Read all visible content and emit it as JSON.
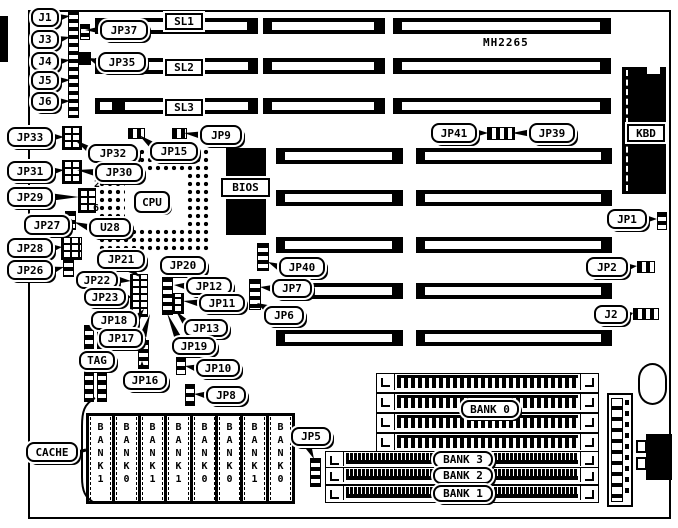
{
  "title": {
    "model": "MH2265"
  },
  "board": {
    "x": 28,
    "y": 10,
    "w": 643,
    "h": 509
  },
  "edge_bar": {
    "x": 0,
    "y": 16,
    "w": 8,
    "h": 46
  },
  "isa_slots": {
    "rows_three_seg": {
      "ys": [
        18,
        58,
        98
      ],
      "h": 16,
      "segments": [
        [
          95,
          258
        ],
        [
          263,
          385
        ],
        [
          393,
          611
        ]
      ]
    },
    "rows_two_seg": {
      "ys": [
        148,
        190,
        237,
        283,
        330
      ],
      "h": 16,
      "segments": [
        [
          276,
          403
        ],
        [
          416,
          612
        ]
      ]
    }
  },
  "cpu": {
    "socket": {
      "x": 98,
      "y": 148,
      "w": 112,
      "h": 104
    },
    "center": {
      "x": 125,
      "y": 173,
      "w": 60,
      "h": 55
    },
    "label": "CPU",
    "label_box": {
      "x": 134,
      "y": 191,
      "w": 36,
      "h": 22
    }
  },
  "bios": {
    "chip": {
      "x": 226,
      "y": 148,
      "w": 40,
      "h": 87
    },
    "label": "BIOS",
    "label_box": {
      "x": 221,
      "y": 178,
      "w": 49,
      "h": 19
    }
  },
  "kbd": {
    "chip": {
      "x": 622,
      "y": 67,
      "w": 44,
      "h": 127
    },
    "notch": {
      "x": 647,
      "y": 67,
      "w": 13,
      "h": 7
    },
    "label": "KBD",
    "label_box": {
      "x": 627,
      "y": 124,
      "w": 38,
      "h": 18
    }
  },
  "tag_chip": {
    "x": 84,
    "y": 325,
    "w": 23,
    "h": 77
  },
  "cache_chips": {
    "y": 413,
    "h": 80,
    "w": 23,
    "xs": [
      86,
      112,
      138,
      164,
      190,
      215,
      240,
      266
    ],
    "labels": [
      "BANK1",
      "BANK0",
      "BANK1",
      "BANK1",
      "BANK0",
      "BANK0",
      "BANK1",
      "BANK0"
    ]
  },
  "simm_bank0": {
    "x": 376,
    "x2": 597,
    "h": 18,
    "ys": [
      373,
      393,
      413,
      433
    ],
    "label": "BANK 0",
    "label_box": {
      "x": 461,
      "y": 400,
      "w": 58,
      "h": 18
    }
  },
  "simm_lower": {
    "x": 325,
    "x2": 597,
    "h": 16,
    "rows": [
      {
        "label": "BANK 3",
        "y": 451
      },
      {
        "label": "BANK 2",
        "y": 467
      },
      {
        "label": "BANK 1",
        "y": 485
      }
    ],
    "label_box": {
      "w": 60,
      "h": 17,
      "x": 433
    }
  },
  "power_connector": {
    "x": 607,
    "y": 393,
    "w": 26,
    "h": 114
  },
  "battery_blob": {
    "x": 638,
    "y": 363,
    "w": 29,
    "h": 42
  },
  "din_connector": {
    "x": 646,
    "y": 434,
    "w": 26,
    "h": 46,
    "tabs": [
      [
        636,
        440
      ],
      [
        636,
        457
      ]
    ]
  },
  "pin_labels": [
    {
      "id": "pin-2",
      "label": "2",
      "x": 94,
      "y": 179
    },
    {
      "id": "pin-6",
      "label": "6",
      "x": 93,
      "y": 203
    }
  ],
  "jumpers": [
    {
      "id": "edge-strip",
      "x": 68,
      "y": 10,
      "w": 9,
      "h": 106,
      "t": "v"
    },
    {
      "id": "jp37-j",
      "x": 80,
      "y": 24,
      "w": 8,
      "h": 14,
      "t": "v"
    },
    {
      "id": "jp35-j",
      "x": 78,
      "y": 52,
      "w": 11,
      "h": 11,
      "t": "s"
    },
    {
      "id": "jp15-j",
      "x": 128,
      "y": 128,
      "w": 15,
      "h": 9,
      "t": "h"
    },
    {
      "id": "jp9-j",
      "x": 172,
      "y": 128,
      "w": 13,
      "h": 9,
      "t": "h"
    },
    {
      "id": "jp33-b",
      "x": 62,
      "y": 126,
      "w": 18,
      "h": 22,
      "t": "b"
    },
    {
      "id": "jp31-b",
      "x": 62,
      "y": 160,
      "w": 18,
      "h": 22,
      "t": "b"
    },
    {
      "id": "jp29-b",
      "x": 78,
      "y": 188,
      "w": 16,
      "h": 23,
      "t": "b"
    },
    {
      "id": "jp27-j",
      "x": 65,
      "y": 211,
      "w": 9,
      "h": 17,
      "t": "v"
    },
    {
      "id": "jp28-b",
      "x": 61,
      "y": 237,
      "w": 19,
      "h": 21,
      "t": "b"
    },
    {
      "id": "jp26-j",
      "x": 63,
      "y": 258,
      "w": 9,
      "h": 17,
      "t": "v"
    },
    {
      "id": "strip-a",
      "x": 130,
      "y": 274,
      "w": 16,
      "h": 41,
      "t": "b"
    },
    {
      "id": "strip-b",
      "x": 162,
      "y": 277,
      "w": 9,
      "h": 36,
      "t": "v"
    },
    {
      "id": "strip-c",
      "x": 172,
      "y": 293,
      "w": 10,
      "h": 19,
      "t": "b"
    },
    {
      "id": "jp16-s",
      "x": 138,
      "y": 340,
      "w": 9,
      "h": 28,
      "t": "v"
    },
    {
      "id": "jp10-j",
      "x": 176,
      "y": 357,
      "w": 8,
      "h": 16,
      "t": "v"
    },
    {
      "id": "jp8-j",
      "x": 185,
      "y": 384,
      "w": 8,
      "h": 20,
      "t": "v"
    },
    {
      "id": "jp40-s",
      "x": 257,
      "y": 243,
      "w": 10,
      "h": 26,
      "t": "v"
    },
    {
      "id": "jp7-s",
      "x": 249,
      "y": 279,
      "w": 10,
      "h": 29,
      "t": "v"
    },
    {
      "id": "jp5-s",
      "x": 310,
      "y": 458,
      "w": 9,
      "h": 27,
      "t": "v"
    },
    {
      "id": "jp41-j",
      "x": 487,
      "y": 127,
      "w": 26,
      "h": 11,
      "t": "h"
    },
    {
      "id": "jp1-j",
      "x": 657,
      "y": 212,
      "w": 8,
      "h": 16,
      "t": "v"
    },
    {
      "id": "jp2-j",
      "x": 637,
      "y": 261,
      "w": 16,
      "h": 10,
      "t": "h"
    },
    {
      "id": "j2-j",
      "x": 633,
      "y": 308,
      "w": 24,
      "h": 10,
      "t": "h"
    }
  ],
  "callouts": [
    {
      "id": "j1",
      "label": "J1",
      "x": 31,
      "y": 8,
      "w": 28,
      "h": 19,
      "to": [
        70,
        16
      ]
    },
    {
      "id": "j3",
      "label": "J3",
      "x": 31,
      "y": 30,
      "w": 28,
      "h": 19,
      "to": [
        70,
        37
      ]
    },
    {
      "id": "j4",
      "label": "J4",
      "x": 31,
      "y": 52,
      "w": 28,
      "h": 19,
      "to": [
        70,
        60
      ]
    },
    {
      "id": "j5",
      "label": "J5",
      "x": 31,
      "y": 71,
      "w": 28,
      "h": 19,
      "to": [
        70,
        80
      ]
    },
    {
      "id": "j6",
      "label": "J6",
      "x": 31,
      "y": 92,
      "w": 28,
      "h": 19,
      "to": [
        70,
        101
      ]
    },
    {
      "id": "jp37",
      "label": "JP37",
      "x": 100,
      "y": 20,
      "w": 48,
      "h": 20,
      "to": [
        85,
        30
      ]
    },
    {
      "id": "jp35",
      "label": "JP35",
      "x": 98,
      "y": 52,
      "w": 48,
      "h": 20,
      "to": [
        88,
        58
      ]
    },
    {
      "id": "jp9",
      "label": "JP9",
      "x": 200,
      "y": 125,
      "w": 42,
      "h": 20,
      "to": [
        184,
        133
      ]
    },
    {
      "id": "jp15",
      "label": "JP15",
      "x": 150,
      "y": 142,
      "w": 48,
      "h": 19,
      "from": [
        152,
        145
      ],
      "to": [
        139,
        135
      ]
    },
    {
      "id": "jp33",
      "label": "JP33",
      "x": 7,
      "y": 127,
      "w": 46,
      "h": 20,
      "to": [
        64,
        137
      ]
    },
    {
      "id": "jp32",
      "label": "JP32",
      "x": 88,
      "y": 144,
      "w": 50,
      "h": 19,
      "from": [
        90,
        150
      ],
      "to": [
        75,
        140
      ]
    },
    {
      "id": "jp31",
      "label": "JP31",
      "x": 7,
      "y": 161,
      "w": 46,
      "h": 20,
      "to": [
        64,
        170
      ]
    },
    {
      "id": "jp30",
      "label": "JP30",
      "x": 95,
      "y": 163,
      "w": 48,
      "h": 19,
      "to": [
        77,
        170
      ]
    },
    {
      "id": "jp29",
      "label": "JP29",
      "x": 7,
      "y": 187,
      "w": 46,
      "h": 20,
      "to": [
        79,
        197
      ]
    },
    {
      "id": "jp27",
      "label": "JP27",
      "x": 24,
      "y": 215,
      "w": 46,
      "h": 20,
      "from": [
        70,
        222
      ],
      "to": [
        68,
        216
      ]
    },
    {
      "id": "u28",
      "label": "U28",
      "x": 89,
      "y": 218,
      "w": 42,
      "h": 19,
      "to": [
        74,
        222
      ]
    },
    {
      "id": "jp28",
      "label": "JP28",
      "x": 7,
      "y": 238,
      "w": 46,
      "h": 20,
      "to": [
        62,
        247
      ]
    },
    {
      "id": "jp26",
      "label": "JP26",
      "x": 7,
      "y": 260,
      "w": 46,
      "h": 20,
      "to": [
        64,
        267
      ]
    },
    {
      "id": "jp21",
      "label": "JP21",
      "x": 97,
      "y": 250,
      "w": 48,
      "h": 19,
      "from": [
        130,
        269
      ],
      "to": [
        140,
        277
      ]
    },
    {
      "id": "jp22",
      "label": "JP22",
      "x": 76,
      "y": 271,
      "w": 42,
      "h": 18,
      "to": [
        131,
        281
      ]
    },
    {
      "id": "jp23",
      "label": "JP23",
      "x": 84,
      "y": 288,
      "w": 42,
      "h": 18,
      "to": [
        131,
        297
      ]
    },
    {
      "id": "jp20",
      "label": "JP20",
      "x": 160,
      "y": 256,
      "w": 46,
      "h": 19,
      "from": [
        172,
        275
      ],
      "to": [
        166,
        282
      ]
    },
    {
      "id": "jp12",
      "label": "JP12",
      "x": 186,
      "y": 277,
      "w": 46,
      "h": 18,
      "to": [
        174,
        285
      ]
    },
    {
      "id": "jp11",
      "label": "JP11",
      "x": 199,
      "y": 294,
      "w": 46,
      "h": 18,
      "to": [
        183,
        301
      ]
    },
    {
      "id": "jp13",
      "label": "JP13",
      "x": 184,
      "y": 319,
      "w": 44,
      "h": 18,
      "from": [
        186,
        323
      ],
      "to": [
        176,
        311
      ]
    },
    {
      "id": "jp19",
      "label": "JP19",
      "x": 172,
      "y": 337,
      "w": 44,
      "h": 18,
      "from": [
        178,
        338
      ],
      "to": [
        167,
        313
      ]
    },
    {
      "id": "jp18",
      "label": "JP18",
      "x": 91,
      "y": 311,
      "w": 46,
      "h": 19,
      "from": [
        137,
        318
      ],
      "to": [
        144,
        309
      ]
    },
    {
      "id": "jp17",
      "label": "JP17",
      "x": 99,
      "y": 329,
      "w": 44,
      "h": 19,
      "from": [
        143,
        336
      ],
      "to": [
        150,
        314
      ]
    },
    {
      "id": "tag",
      "label": "TAG",
      "x": 79,
      "y": 351,
      "w": 36,
      "h": 19
    },
    {
      "id": "jp16",
      "label": "JP16",
      "x": 123,
      "y": 371,
      "w": 44,
      "h": 19,
      "from": [
        142,
        371
      ],
      "to": [
        142,
        361
      ]
    },
    {
      "id": "jp10",
      "label": "JP10",
      "x": 196,
      "y": 359,
      "w": 44,
      "h": 18,
      "to": [
        185,
        366
      ]
    },
    {
      "id": "jp8",
      "label": "JP8",
      "x": 206,
      "y": 386,
      "w": 40,
      "h": 18,
      "to": [
        194,
        394
      ]
    },
    {
      "id": "jp40",
      "label": "JP40",
      "x": 279,
      "y": 257,
      "w": 46,
      "h": 20,
      "to": [
        268,
        262
      ]
    },
    {
      "id": "jp7",
      "label": "JP7",
      "x": 272,
      "y": 279,
      "w": 40,
      "h": 19,
      "to": [
        260,
        287
      ]
    },
    {
      "id": "jp6",
      "label": "JP6",
      "x": 264,
      "y": 306,
      "w": 40,
      "h": 19,
      "from": [
        266,
        308
      ],
      "to": [
        257,
        303
      ]
    },
    {
      "id": "jp41",
      "label": "JP41",
      "x": 431,
      "y": 123,
      "w": 46,
      "h": 20,
      "to": [
        488,
        133
      ]
    },
    {
      "id": "jp39",
      "label": "JP39",
      "x": 529,
      "y": 123,
      "w": 46,
      "h": 20,
      "to": [
        512,
        133
      ]
    },
    {
      "id": "jp1",
      "label": "JP1",
      "x": 607,
      "y": 209,
      "w": 40,
      "h": 20,
      "to": [
        657,
        219
      ]
    },
    {
      "id": "jp2",
      "label": "JP2",
      "x": 586,
      "y": 257,
      "w": 42,
      "h": 20,
      "to": [
        637,
        266
      ]
    },
    {
      "id": "j2",
      "label": "J2",
      "x": 594,
      "y": 305,
      "w": 34,
      "h": 19,
      "to": [
        633,
        313
      ]
    },
    {
      "id": "jp5",
      "label": "JP5",
      "x": 291,
      "y": 427,
      "w": 40,
      "h": 19,
      "from": [
        308,
        446
      ],
      "to": [
        314,
        459
      ]
    },
    {
      "id": "cache",
      "label": "CACHE",
      "x": 26,
      "y": 442,
      "w": 52,
      "h": 20
    }
  ],
  "square_labels": [
    {
      "id": "sl1",
      "label": "SL1",
      "x": 165,
      "y": 13,
      "w": 38,
      "h": 17
    },
    {
      "id": "sl2",
      "label": "SL2",
      "x": 165,
      "y": 59,
      "w": 38,
      "h": 17
    },
    {
      "id": "sl3",
      "label": "SL3",
      "x": 165,
      "y": 99,
      "w": 38,
      "h": 17
    }
  ],
  "cache_brace": {
    "path": "M95,398 C84,404 82,412 82,426 L82,477 C82,491 85,498 95,503",
    "tick": "M78,452 L86,450"
  }
}
